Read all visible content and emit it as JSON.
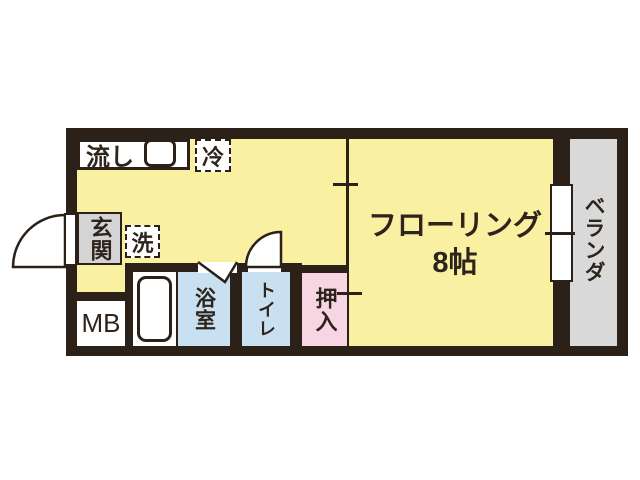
{
  "title": "floor-plan",
  "colors": {
    "wall": "#2b2118",
    "floor": "#faf0a2",
    "wet_area": "#c9e0f1",
    "closet": "#f8d5e3",
    "gray_area": "#d9d9d9",
    "white": "#ffffff",
    "text": "#2d241b"
  },
  "rooms": {
    "main_room": {
      "label_line1": "フローリング",
      "label_line2": "8帖"
    },
    "veranda": {
      "label": "ベランダ"
    },
    "entrance": {
      "label": "玄関"
    },
    "bathroom": {
      "label": "浴室"
    },
    "toilet": {
      "label": "トイレ"
    },
    "closet": {
      "label": "押入"
    },
    "meter_box": {
      "label": "MB"
    }
  },
  "fixtures": {
    "sink": {
      "label": "流し"
    },
    "refrigerator": {
      "label": "冷"
    },
    "washing_machine": {
      "label": "洗"
    }
  }
}
